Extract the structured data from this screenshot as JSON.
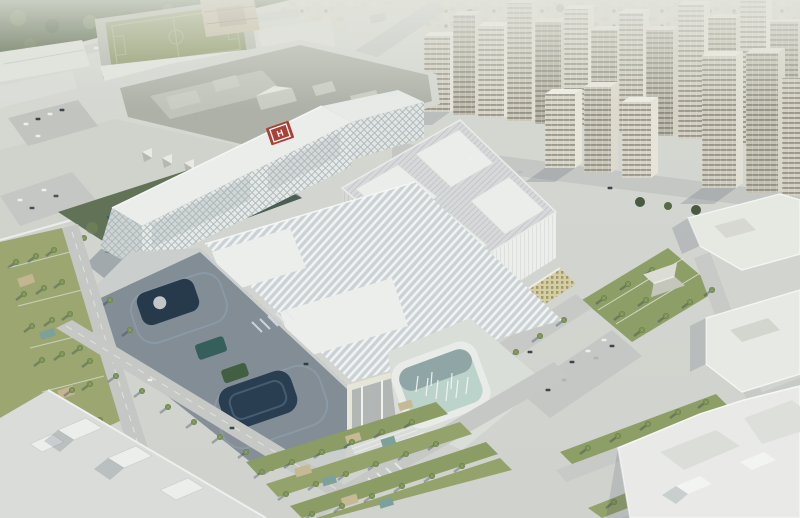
{
  "scene": {
    "kind": "aerial-architectural-rendering",
    "description": "Daytime aerial rendering of a large white hospital campus masterplan: diagrid-facade building with rooftop helipad, large diamond-oriented ribbed atrium roof, louvered canopy building with yellow-green mosaic facade, fountain plaza, palm-lined streets and gardens, existing low-rise complex and sports field upper-left, row of beige high-rise towers along the top, white residential blocks lower-right.",
    "helipad_letter": "H"
  },
  "palette": {
    "ground": "#d5d6d1",
    "road": "#c7c9c4",
    "roof_white": "#eef0ed",
    "complex_roof": "#aeb0a6",
    "field_green": "#87915a",
    "tree_green": "#44553a",
    "palm_green": "#66793f",
    "tower_beige": "#d3cfc2",
    "tower_window": "#6b685c",
    "diagrid_white": "#eef0ec",
    "helipad_red": "#a93a31",
    "mosaic_yellow": "#c2c187",
    "atrium_roof": "#d8dadb",
    "shadow_blue": "#24384e",
    "pool_aqua": "#bdd4cc",
    "lawn": "#8d9c62"
  },
  "landmarks": {
    "helipad": "rooftop helipad",
    "sports_field": "sports pitch",
    "towers": "high-rise tower row",
    "atrium": "diamond ribbed atrium roof",
    "canopy_building": "louvered canopy building",
    "fountain": "fountain pool plaza",
    "park": "palm park"
  }
}
